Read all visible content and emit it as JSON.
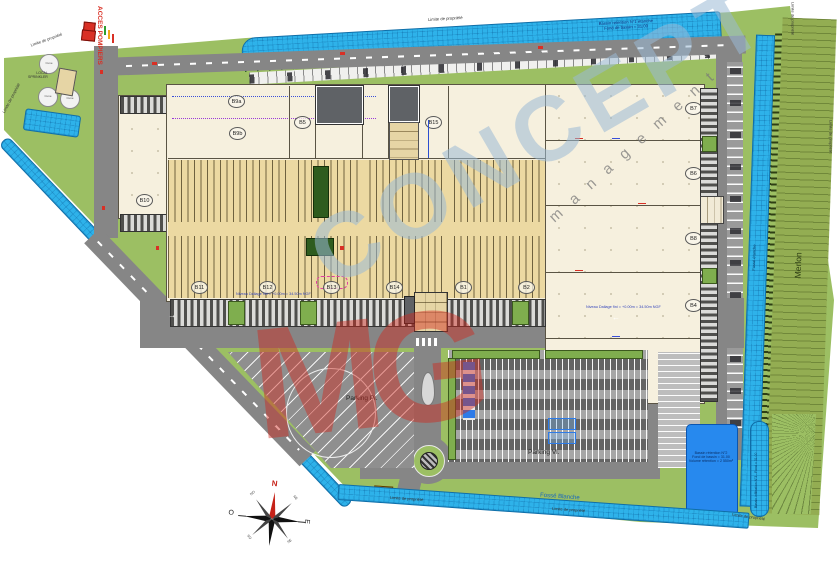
{
  "title": "Plan de masse site logistique",
  "labels": {
    "limite": "Limite de propriété",
    "acces_pompiers": "ACCES POMPIERS",
    "local_sprinkler_l1": "LOCAL",
    "local_sprinkler_l2": "SPRINKLER",
    "cuve": "Cuve",
    "merlon": "Merlon",
    "fosse_etanche": "Fossé étanche",
    "fosse_blanche": "Fossé Blanche",
    "parking_pl": "Parking Pl.",
    "parking_vl": "Parking Vl.",
    "niveau_note": "Niveau Dallage fini = +0.00m = 34.50m NGF"
  },
  "bassins": {
    "nord_l1": "Bassin rétention N°1 étanche",
    "nord_l2": "Fond de bassin = 31.00",
    "sud_l1": "Bassin rétention N°2",
    "sud_l2": "Fond de bassin = 31.00",
    "sud_l3": "Volume rétention = 2 550m³",
    "infiltration": "Bassin infiltration N°3 - Fond = 31.00"
  },
  "cells": {
    "b9a": "B9a",
    "b9b": "B9b",
    "b10": "B10",
    "b5": "B5",
    "b15": "B15",
    "bottom": [
      "B11",
      "B12",
      "B13",
      "B14",
      "B1",
      "B2"
    ],
    "right": [
      "B7",
      "B6",
      "B8",
      "B4",
      "B3"
    ]
  },
  "compass": {
    "n": "N",
    "o": "O",
    "e": "E",
    "ne": "NE",
    "no": "NO",
    "se": "SE",
    "so": "SO"
  },
  "watermark": {
    "mg": "MG",
    "concept": "CONCEPT",
    "management": "m a n a g e m e n t"
  },
  "road_arrow": "←",
  "colors": {
    "water": "#2eb2ea",
    "deep_water": "#2789ee",
    "site_green": "#9cbf63",
    "road_grey": "#868686",
    "building_cream": "#f6f0de",
    "rack_tan": "#ecd9a2",
    "watermark_red": "#d0281c",
    "watermark_blue": "#9bbad6"
  }
}
